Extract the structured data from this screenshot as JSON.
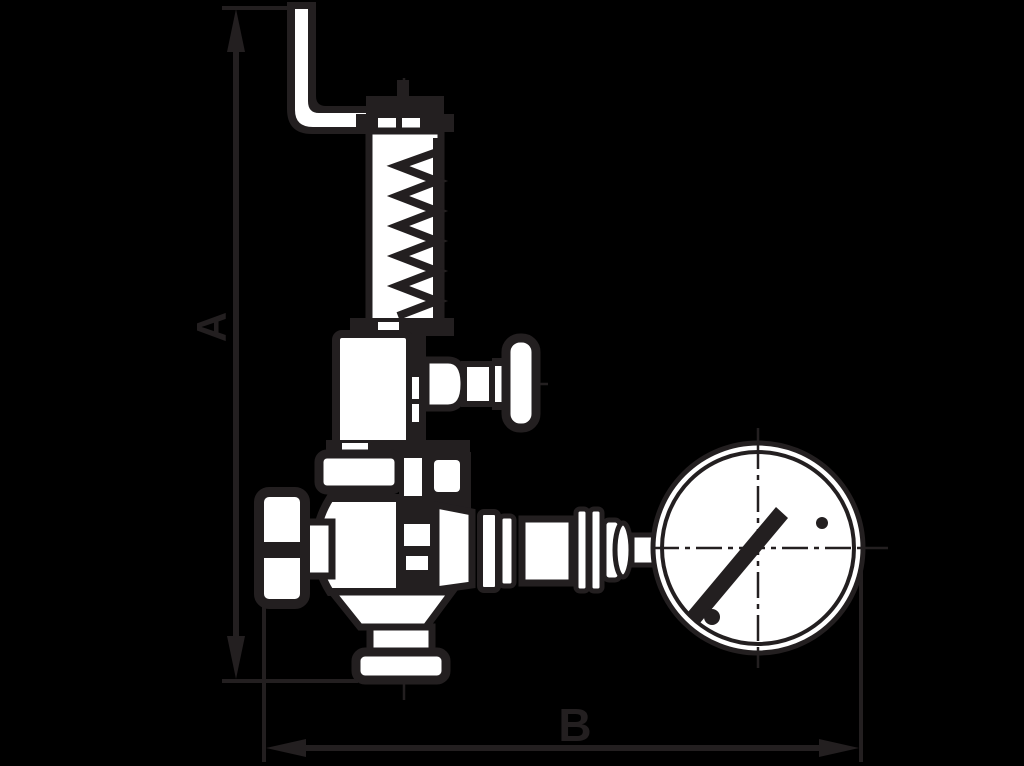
{
  "diagram": {
    "dimension_labels": {
      "vertical": "A",
      "horizontal": "B"
    },
    "colors": {
      "background": "#000000",
      "line": "#231F20",
      "fill": "#FFFFFF"
    }
  }
}
